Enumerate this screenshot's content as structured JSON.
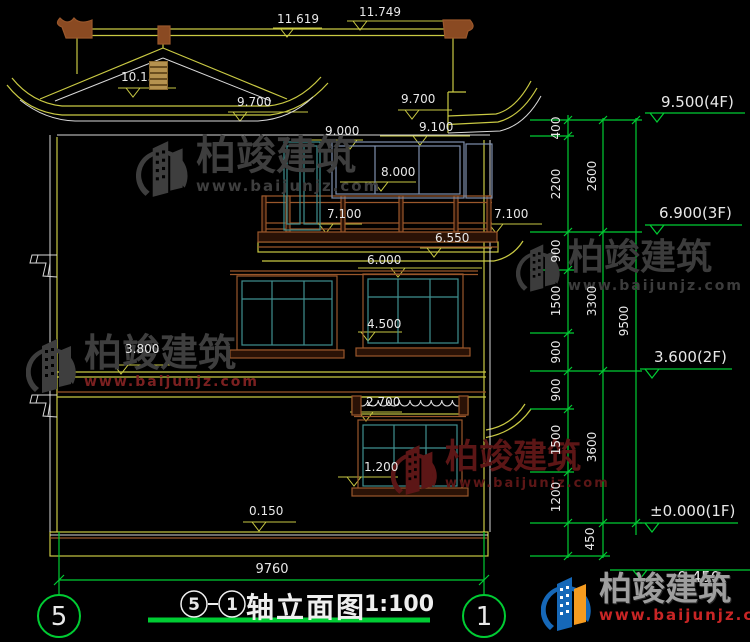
{
  "watermark": {
    "brand": "柏竣建筑",
    "url": "www.baijunjz.com"
  },
  "title_bar": {
    "bubble_left": "5",
    "bubble_right": "1",
    "title": "轴立面图",
    "scale": "1:100"
  },
  "axis_bubbles": {
    "left": "5",
    "right": "1"
  },
  "bottom_dim": {
    "label": "9760"
  },
  "annotations": {
    "levels_building": [
      {
        "label": "11.619",
        "x": 277,
        "y": 13
      },
      {
        "label": "11.749",
        "x": 359,
        "y": 6
      },
      {
        "label": "10.158",
        "x": 121,
        "y": 71
      },
      {
        "label": "9.700",
        "x": 237,
        "y": 96
      },
      {
        "label": "9.700",
        "x": 401,
        "y": 93
      },
      {
        "label": "9.000",
        "x": 325,
        "y": 125
      },
      {
        "label": "9.100",
        "x": 419,
        "y": 121
      },
      {
        "label": "8.000",
        "x": 381,
        "y": 166
      },
      {
        "label": "7.100",
        "x": 327,
        "y": 208
      },
      {
        "label": "7.100",
        "x": 494,
        "y": 208
      },
      {
        "label": "6.550",
        "x": 435,
        "y": 232
      },
      {
        "label": "6.000",
        "x": 367,
        "y": 254
      },
      {
        "label": "4.500",
        "x": 367,
        "y": 318
      },
      {
        "label": "3.800",
        "x": 125,
        "y": 343
      },
      {
        "label": "2.700",
        "x": 366,
        "y": 396
      },
      {
        "label": "1.200",
        "x": 364,
        "y": 461
      },
      {
        "label": "0.150",
        "x": 249,
        "y": 505
      }
    ],
    "levels_grid": [
      {
        "label": "9.500(4F)",
        "x": 661,
        "y": 95
      },
      {
        "label": "6.900(3F)",
        "x": 659,
        "y": 206
      },
      {
        "label": "3.600(2F)",
        "x": 654,
        "y": 350
      },
      {
        "label": "±0.000(1F)",
        "x": 650,
        "y": 504
      },
      {
        "label": "-0.450",
        "x": 672,
        "y": 570
      }
    ],
    "dims_vertical": [
      {
        "label": "400",
        "x": 556,
        "y": 128
      },
      {
        "label": "2200",
        "x": 556,
        "y": 184
      },
      {
        "label": "900",
        "x": 556,
        "y": 251
      },
      {
        "label": "1500",
        "x": 556,
        "y": 301
      },
      {
        "label": "900",
        "x": 556,
        "y": 352
      },
      {
        "label": "900",
        "x": 556,
        "y": 390
      },
      {
        "label": "1500",
        "x": 556,
        "y": 440
      },
      {
        "label": "1200",
        "x": 556,
        "y": 497
      },
      {
        "label": "450",
        "x": 590,
        "y": 539
      },
      {
        "label": "2600",
        "x": 592,
        "y": 176
      },
      {
        "label": "3300",
        "x": 592,
        "y": 301
      },
      {
        "label": "3600",
        "x": 592,
        "y": 447
      },
      {
        "label": "9500",
        "x": 624,
        "y": 321
      }
    ]
  }
}
